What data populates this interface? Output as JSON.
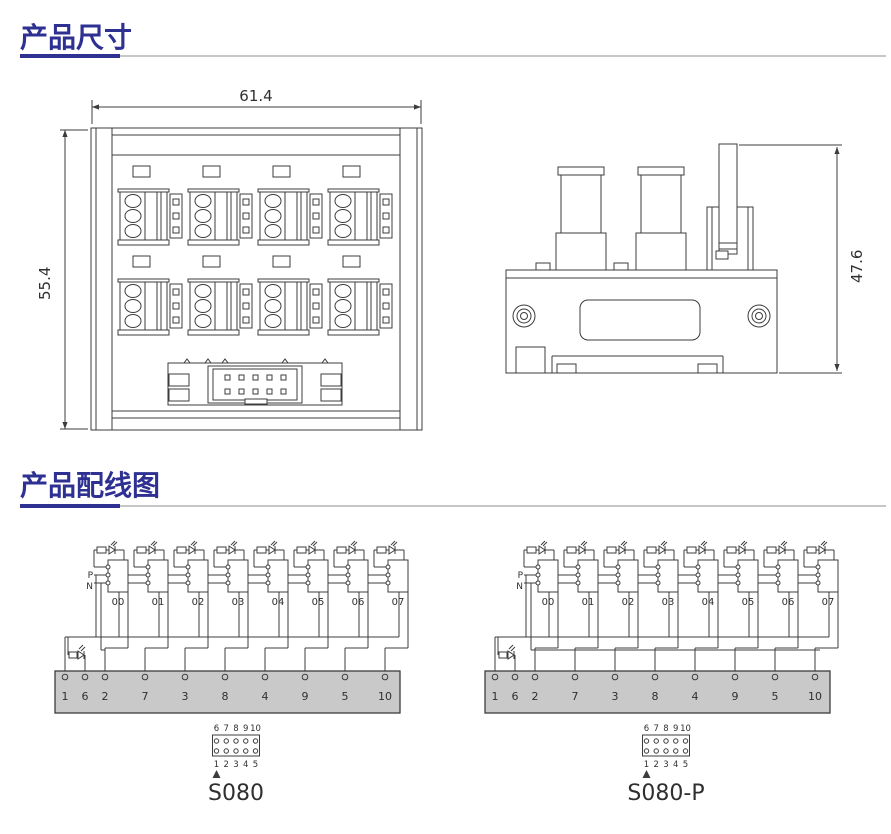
{
  "sections": {
    "dimensions": {
      "title": "产品尺寸"
    },
    "wiring": {
      "title": "产品配线图"
    }
  },
  "colors": {
    "accent": "#2e3192",
    "rule_gray": "#c6c6c6",
    "line": "#3c3c3c",
    "text": "#2f2f2f",
    "bus_bar_fill": "#c9c9c9"
  },
  "front_view": {
    "width_dim": "61.4",
    "height_dim": "55.4"
  },
  "side_view": {
    "height_dim": "47.6"
  },
  "wiring_diagrams": [
    {
      "model": "S080",
      "p_label": "P",
      "n_label": "N",
      "channels": [
        "00",
        "01",
        "02",
        "03",
        "04",
        "05",
        "06",
        "07"
      ],
      "terminals": [
        "1",
        "6",
        "2",
        "7",
        "3",
        "8",
        "4",
        "9",
        "5",
        "10"
      ],
      "connector_pins_top": [
        "6",
        "7",
        "8",
        "9",
        "10"
      ],
      "connector_pins_bottom": [
        "1",
        "2",
        "3",
        "4",
        "5"
      ]
    },
    {
      "model": "S080-P",
      "p_label": "P",
      "n_label": "N",
      "channels": [
        "00",
        "01",
        "02",
        "03",
        "04",
        "05",
        "06",
        "07"
      ],
      "terminals": [
        "1",
        "6",
        "2",
        "7",
        "3",
        "8",
        "4",
        "9",
        "5",
        "10"
      ],
      "connector_pins_top": [
        "6",
        "7",
        "8",
        "9",
        "10"
      ],
      "connector_pins_bottom": [
        "1",
        "2",
        "3",
        "4",
        "5"
      ]
    }
  ]
}
